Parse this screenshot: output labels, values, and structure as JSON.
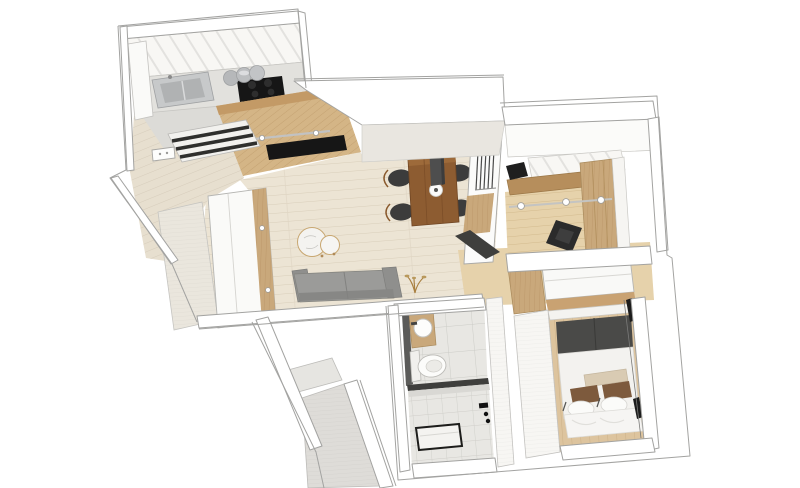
{
  "meta": {
    "title": "3D apartment floor plan — top-down axonometric render",
    "background": "#ffffff"
  },
  "colors": {
    "wallStroke": "#a3a3a1",
    "wallFill": "#ffffff",
    "wallFace": "#f4f3f0",
    "marbleWall": "#e9e6e0",
    "floorLiving": "#ece4d4",
    "plankLine": "#d9ceba",
    "floorEntry": "#e7dfcf",
    "floorOffice": "#e6d2ab",
    "floorBedroom": "#ddc49e",
    "floorKitchen": "#dcdbd7",
    "stoneFloor": "#dedcd8",
    "tileBase": "#e8e7e3",
    "tileLine": "#ccccc7",
    "woodLight": "#d4b586",
    "woodMid": "#c9a87b",
    "woodDesk": "#b68e5c",
    "woodEdge": "#c39a66",
    "tableWood": "#8d5c31",
    "chairWood": "#8a5a2e",
    "counter": "#e2e1dd",
    "steel": "#c7c9ca",
    "steelDark": "#b0b2b3",
    "applianceBlack": "#161616",
    "sofaGray": "#9b9b99",
    "sofaDark": "#8f8f8d",
    "chairSeat": "#3c3c3c",
    "pendantGray": "#4e4e4e",
    "headboard": "#4a4a48",
    "pillowBrown": "#7d5a3d",
    "bolsterTan": "#d9cbb3",
    "duvetWhite": "#f6f5f3",
    "curtainBlack": "#1c1c1c",
    "doorDark": "#3f3f3d",
    "matStripe": "#2f2f2d"
  },
  "rooms": [
    {
      "id": "kitchen",
      "label": "Kitchen",
      "items": [
        "upper-cabinets",
        "countertop",
        "stainless-sink",
        "black-cooktop",
        "metal-canisters",
        "wood-island",
        "tv-panel",
        "shelf-rail"
      ]
    },
    {
      "id": "entry",
      "label": "Entry Hall",
      "items": [
        "striped-doormat",
        "wall-switch",
        "textured-wall"
      ]
    },
    {
      "id": "living-room",
      "label": "Living / Dining Room",
      "items": [
        "wardrobe",
        "sofa",
        "round-coffee-tables",
        "plant",
        "dining-table",
        "four-dining-chairs",
        "pendant-lamp",
        "plate",
        "glass-partition",
        "dark-door"
      ]
    },
    {
      "id": "office",
      "label": "Home Office",
      "items": [
        "desk",
        "monitor",
        "office-chair",
        "wood-wardrobe",
        "light-rail",
        "upper-cabinets"
      ]
    },
    {
      "id": "hallway",
      "label": "Hallway / Closet",
      "items": [
        "wood-cabinet",
        "white-wardrobe-box",
        "wood-shelf-strip"
      ]
    },
    {
      "id": "bedroom",
      "label": "Bedroom",
      "items": [
        "double-bed",
        "dark-headboard",
        "bolster",
        "two-brown-pillows",
        "white-pillows",
        "duvet",
        "curtains",
        "wood-floor-strip"
      ]
    },
    {
      "id": "bathroom",
      "label": "Bathroom",
      "items": [
        "wood-vanity",
        "round-basin",
        "toilet",
        "glass-divider",
        "shower-floor",
        "shower-tray",
        "black-fixtures",
        "dark-door-strip"
      ]
    },
    {
      "id": "balcony",
      "label": "Entrance / Balcony",
      "items": [
        "stone-floor",
        "step",
        "angled-walls"
      ]
    }
  ]
}
